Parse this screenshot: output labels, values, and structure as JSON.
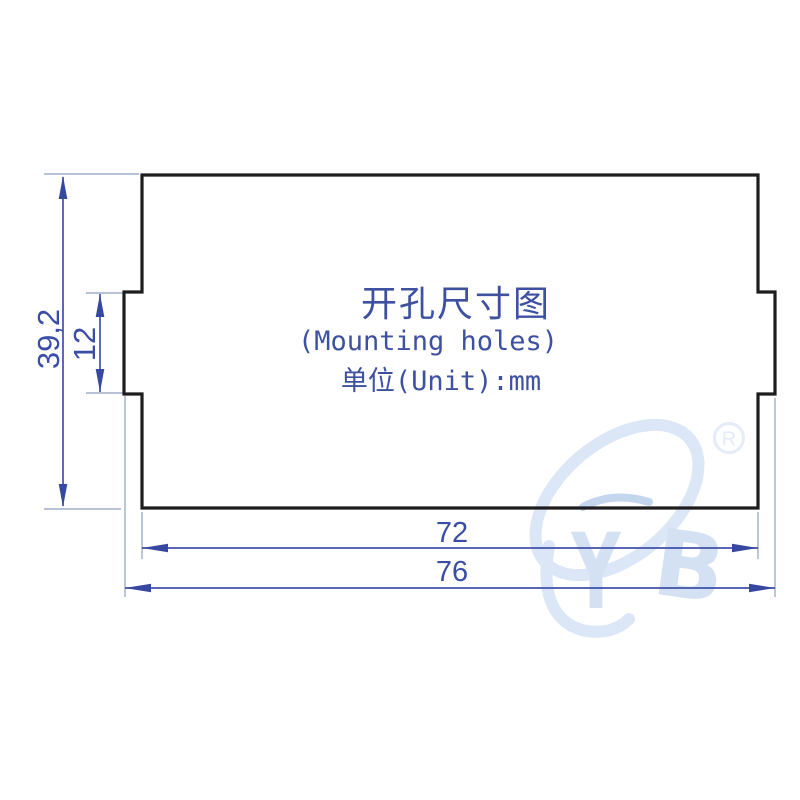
{
  "drawing": {
    "title_cn": "开孔尺寸图",
    "title_en": "(Mounting holes)",
    "unit_text": "单位(Unit):mm",
    "dim_total_height": "39,2",
    "dim_notch_height": "12",
    "dim_body_width": "72",
    "dim_total_width": "76"
  },
  "watermark": {
    "letter_y": "Y",
    "letter_b": "B",
    "registered_mark": "R"
  },
  "colors": {
    "outline": "#1d1d1f",
    "dimension_line": "#3f51a8",
    "dimension_text": "#3a4da6",
    "title_text": "#3e50a0",
    "extension_line": "#9fadc9",
    "watermark": "#dbe7f6",
    "background": "#ffffff"
  }
}
